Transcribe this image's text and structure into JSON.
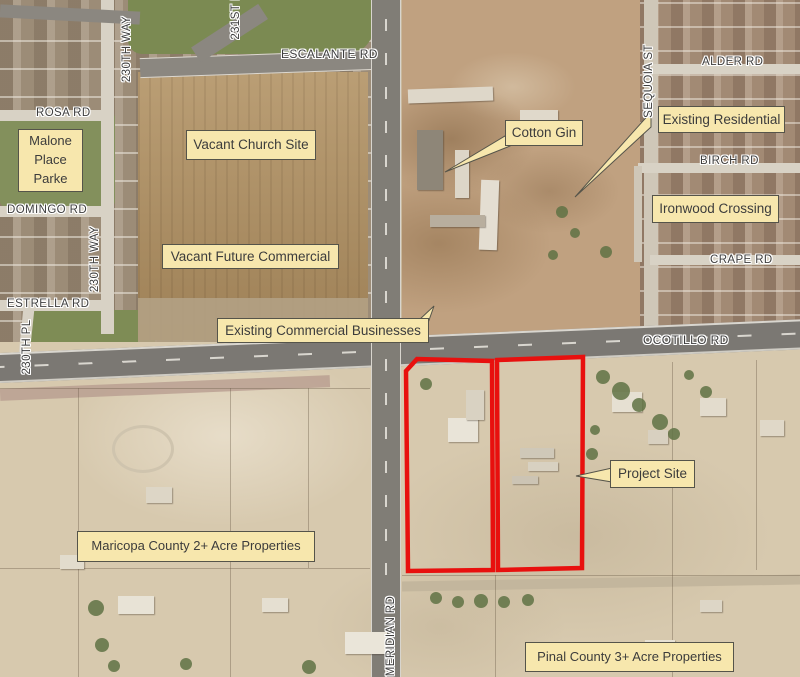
{
  "map_type": "aerial-site-map",
  "colors": {
    "label_background": "#f7e7ad",
    "label_border": "#55544a",
    "label_text": "#3c3c3c",
    "street_label_text": "#3e3e3e",
    "street_label_halo": "#ffffff",
    "project_outline": "#e8100e"
  },
  "area_labels": {
    "malone": "Malone Place Parke",
    "vacant_church": "Vacant Church Site",
    "cotton_gin": "Cotton Gin",
    "existing_residential": "Existing Residential",
    "ironwood": "Ironwood Crossing",
    "vacant_future": "Vacant Future Commercial",
    "existing_commercial": "Existing Commercial Businesses",
    "project_site": "Project Site",
    "maricopa": "Maricopa County 2+ Acre Properties",
    "pinal": "Pinal County 3+ Acre Properties"
  },
  "street_labels": {
    "escalante": "ESCALANTE RD",
    "rosa": "ROSA RD",
    "domingo": "DOMINGO RD",
    "estrella": "ESTRELLA RD",
    "alder": "ALDER RD",
    "birch": "BIRCH RD",
    "crape": "CRAPE RD",
    "ocotillo": "OCOTILLO RD",
    "way230_north": "230TH WAY",
    "way230_south": "230TH WAY",
    "pl230": "230TH PL",
    "pl231": "231ST P",
    "sequoia": "SEQUOIA ST",
    "meridian": "MERIDIAN RD"
  }
}
